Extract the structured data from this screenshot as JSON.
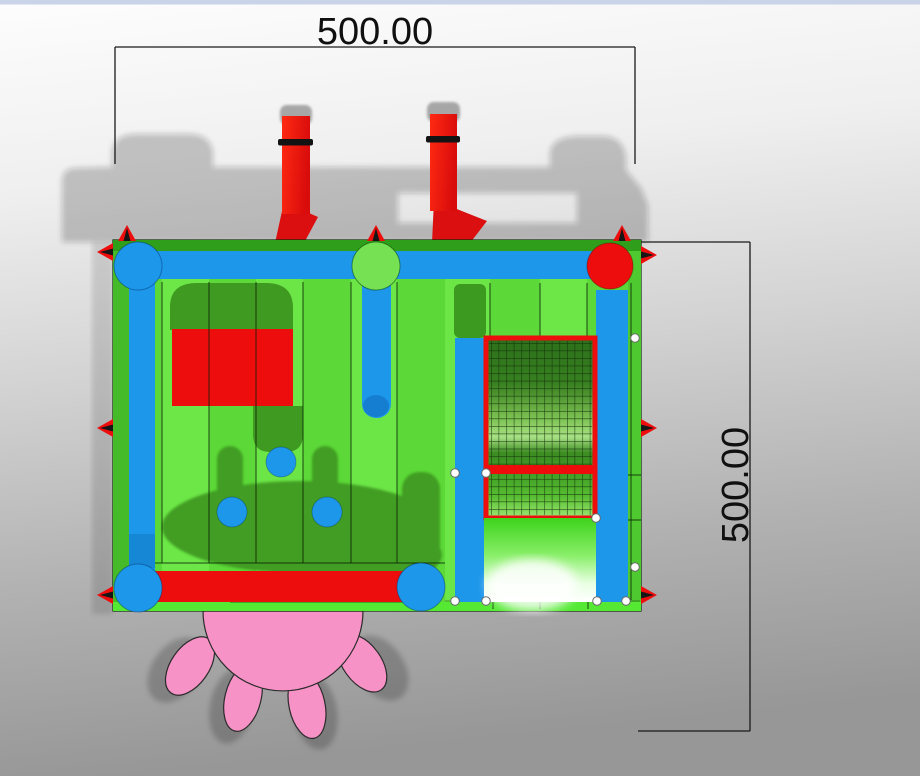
{
  "scene": {
    "type": "3d-top-view-render",
    "subject": "inflatable bounce house combo with mesh climb panel, slide and flower splash pad"
  },
  "dimensions": {
    "width": {
      "label": "500.00"
    },
    "height": {
      "label": "500.00"
    }
  },
  "theme": {
    "bg_top": "#fdfdfd",
    "bg_bottom": "#979797",
    "top_bar": "#c9d4e8",
    "dim_line": "#1a1a1a",
    "floor_green": "#5cd938",
    "floor_light": "#6fe94a",
    "edge_green": "#2f9e1b",
    "side_green": "#46bb2a",
    "bottom_green": "#55e934",
    "shadow_green": "#3f9a22",
    "tube_blue": "#1d97ea",
    "accent_red": "#ee0d0d",
    "knob_green": "#76e253",
    "mesh_dark": "#2c701a",
    "mesh_light": "#a8e184",
    "slide_green": "#3ed31c",
    "flower_pink": "#f792c6",
    "handle_white": "#ffffff"
  }
}
